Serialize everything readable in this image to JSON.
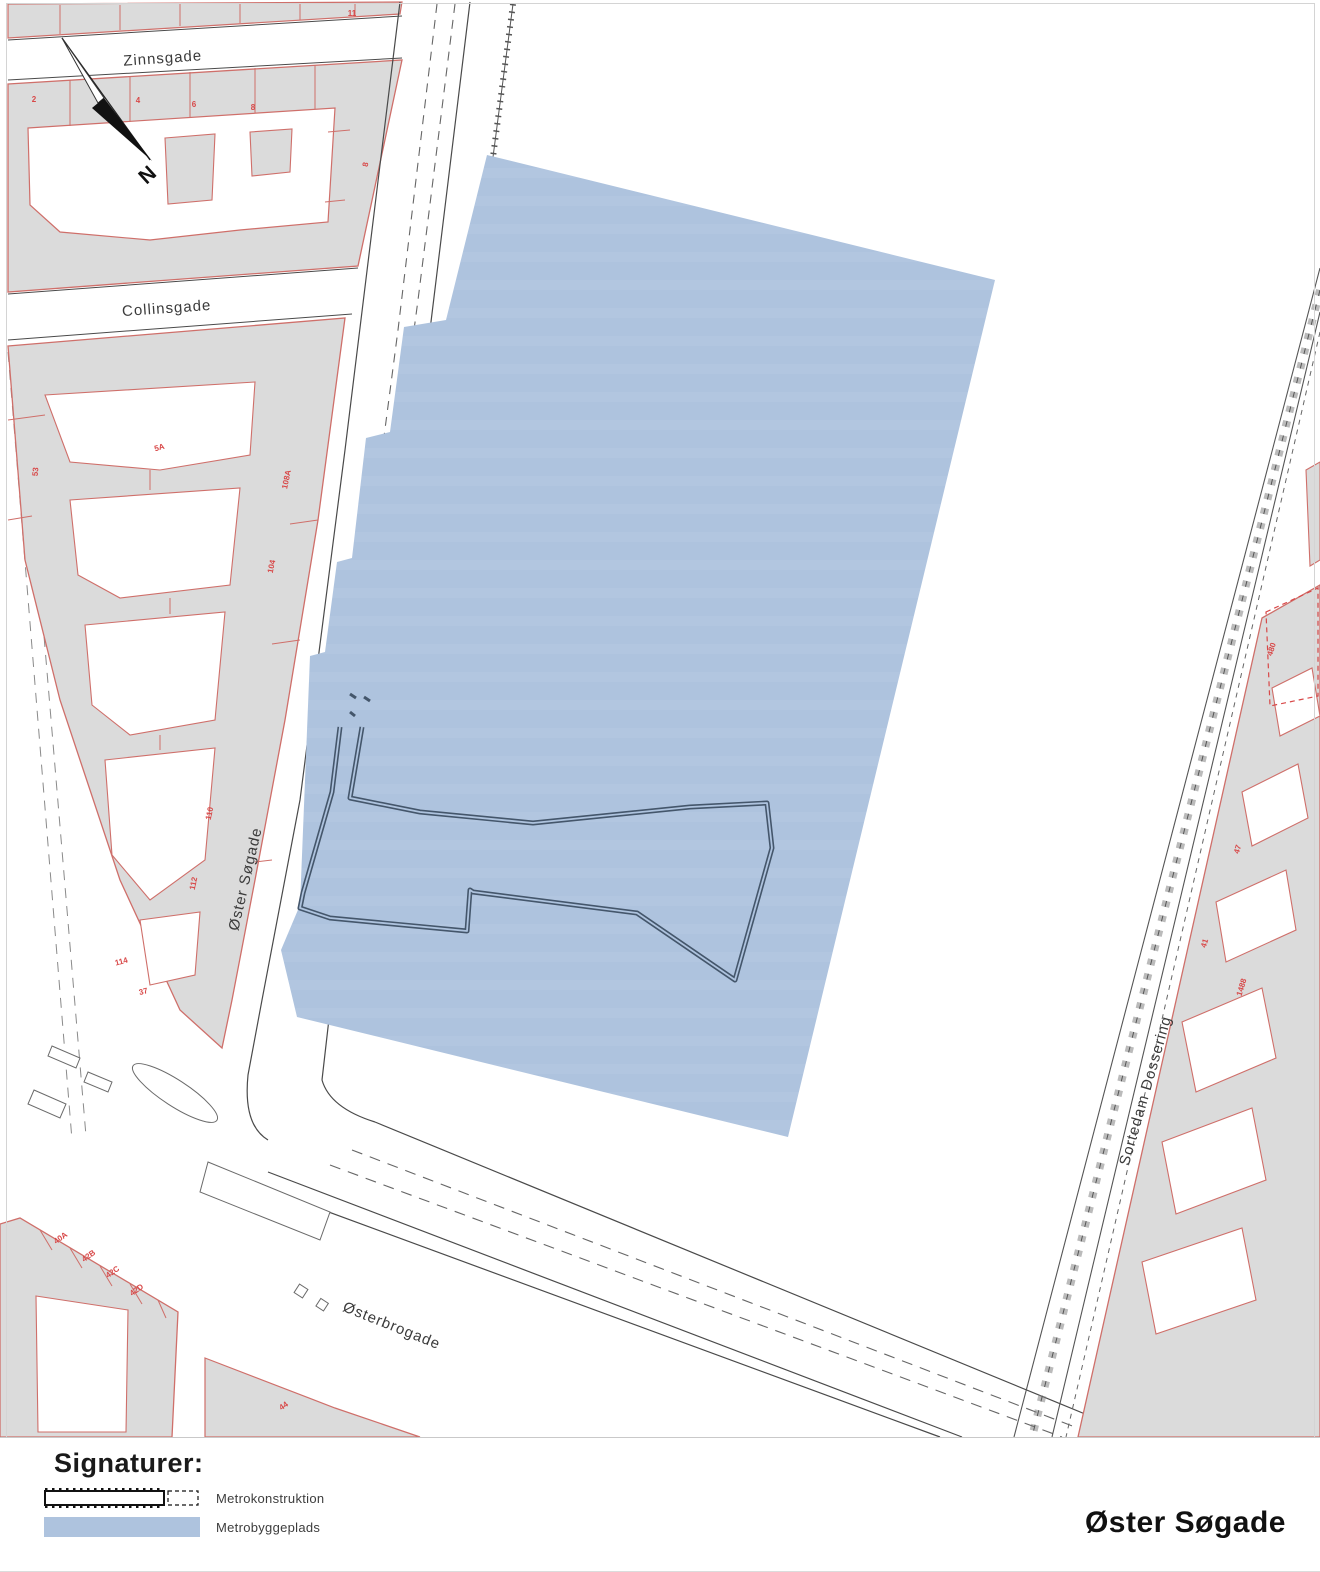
{
  "page": {
    "title": "Øster Søgade",
    "background": "#ffffff"
  },
  "map": {
    "north_label": "N",
    "street_labels": [
      {
        "text": "Zinnsgade"
      },
      {
        "text": "Collinsgade"
      },
      {
        "text": "Øster Søgade"
      },
      {
        "text": "Østerbrogade"
      },
      {
        "text": "Sortedam Dossering"
      }
    ],
    "parcel_numbers": [
      {
        "text": "11"
      },
      {
        "text": "2"
      },
      {
        "text": "4"
      },
      {
        "text": "6"
      },
      {
        "text": "8"
      },
      {
        "text": "8"
      },
      {
        "text": "5A"
      },
      {
        "text": "108A"
      },
      {
        "text": "104"
      },
      {
        "text": "110"
      },
      {
        "text": "112"
      },
      {
        "text": "114"
      },
      {
        "text": "37"
      },
      {
        "text": "53"
      },
      {
        "text": "40A"
      },
      {
        "text": "42B"
      },
      {
        "text": "42C"
      },
      {
        "text": "42D"
      },
      {
        "text": "44"
      },
      {
        "text": "480"
      },
      {
        "text": "47"
      },
      {
        "text": "41"
      },
      {
        "text": "1488"
      }
    ],
    "colors": {
      "site_fill": "#aec3de",
      "construction_outline": "#44566b",
      "building_fill": "#dbdbdb",
      "parcel_line": "#cf6f6a",
      "parcel_number": "#d84848",
      "street_line": "#555555"
    }
  },
  "legend": {
    "heading": "Signaturer:",
    "items": [
      {
        "symbol": "metro-construction-line",
        "label": "Metrokonstruktion"
      },
      {
        "symbol": "metro-site-area",
        "label": "Metrobyggeplads",
        "color": "#aec3de"
      }
    ]
  }
}
